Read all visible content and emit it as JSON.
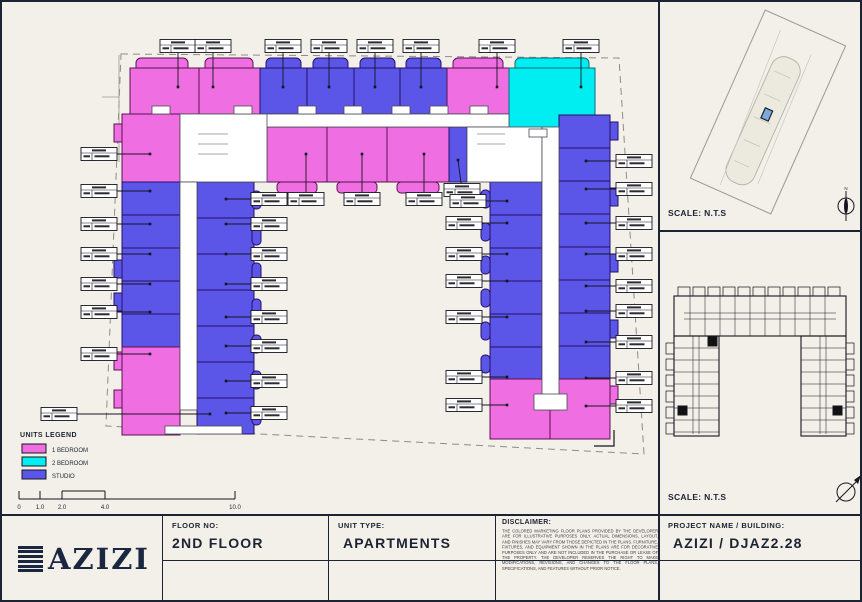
{
  "colors": {
    "one_bedroom": "#ef6fe2",
    "two_bedroom": "#00eef2",
    "studio": "#5b55e8",
    "paper": "#f2f0e8",
    "ink": "#1c2333"
  },
  "legend": {
    "title": "UNITS LEGEND",
    "items": [
      {
        "label": "1 BEDROOM",
        "color": "#ef6fe2"
      },
      {
        "label": "2 BEDROOM",
        "color": "#00eef2"
      },
      {
        "label": "STUDIO",
        "color": "#5b55e8"
      }
    ]
  },
  "scale_bar": {
    "ticks": [
      "0",
      "1.0",
      "2.0",
      "4.0",
      "10.0"
    ]
  },
  "location_map": {
    "scale_label": "SCALE: N.T.S",
    "north_label": "N"
  },
  "key_plan": {
    "scale_label": "SCALE: N.T.S"
  },
  "title_block": {
    "logo_text": "AZIZI",
    "floor": {
      "label": "FLOOR NO:",
      "value": "2ND FLOOR"
    },
    "unit_type": {
      "label": "UNIT TYPE:",
      "value": "APARTMENTS"
    },
    "disclaimer": {
      "label": "DISCLAIMER:",
      "text": "THE COLORED MARKETING FLOOR PLANS PROVIDED BY THE DEVELOPER ARE FOR ILLUSTRATIVE PURPOSES ONLY. ACTUAL DIMENSIONS, LAYOUT, AND FINISHES MAY VARY FROM THOSE DEPICTED IN THE PLANS. FURNITURE, FIXTURES, AND EQUIPMENT SHOWN IN THE PLANS ARE FOR DECORATIVE PURPOSES ONLY AND ARE NOT INCLUDED IN THE PURCHASE OR LEASE OF THE PROPERTY. THE DEVELOPER RESERVES THE RIGHT TO MAKE MODIFICATIONS, REVISIONS, AND CHANGES TO THE FLOOR PLANS, SPECIFICATIONS, AND FEATURES WITHOUT PRIOR NOTICE."
    },
    "project": {
      "label": "PROJECT NAME / BUILDING:",
      "value": "AZIZI / DJAZ2.28"
    }
  }
}
